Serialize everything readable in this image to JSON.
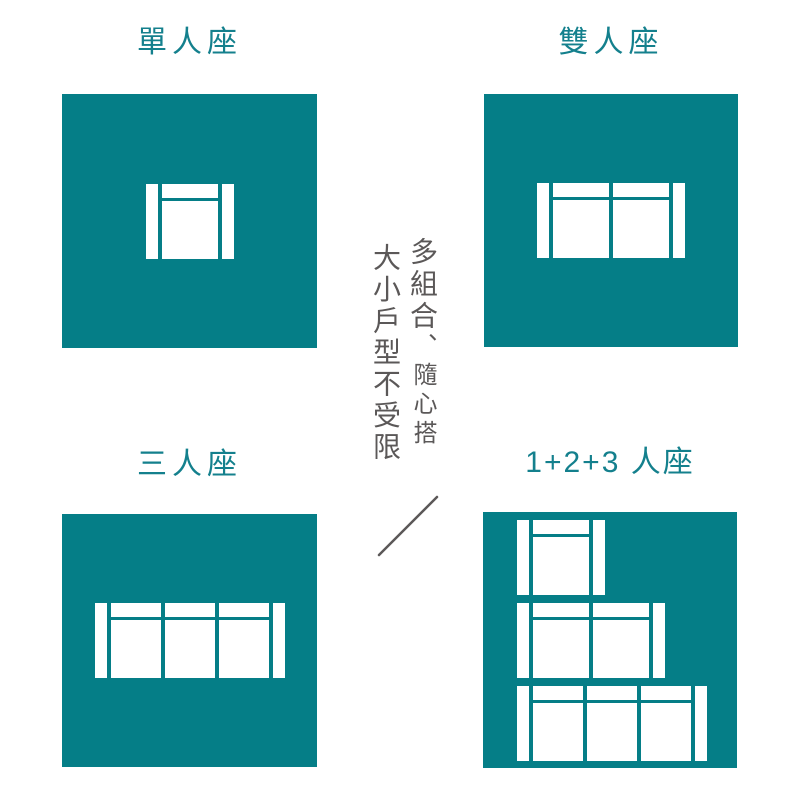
{
  "colors": {
    "background": "#FFFFFF",
    "teal": "#057E87",
    "title-teal": "#14808D",
    "grey": "#5B5858",
    "sofa-white": "#FFFFFF"
  },
  "panels": [
    {
      "label": "單人座",
      "icon": "sofa-1-seat-top-view-icon",
      "sofas": [
        1
      ]
    },
    {
      "label": "雙人座",
      "icon": "sofa-2-seat-top-view-icon",
      "sofas": [
        2
      ]
    },
    {
      "label": "三人座",
      "icon": "sofa-3-seat-top-view-icon",
      "sofas": [
        3
      ]
    },
    {
      "label": "1+2+3 人座",
      "icon": "sofa-1-2-3-combo-top-view-icon",
      "sofas": [
        1,
        2,
        3
      ]
    }
  ],
  "center_text": {
    "right_column_primary": "多組合",
    "right_column_secondary": "、隨心搭",
    "left_column": "大小戶型不受限"
  },
  "decorations": {
    "slash": "diagonal-slash"
  }
}
